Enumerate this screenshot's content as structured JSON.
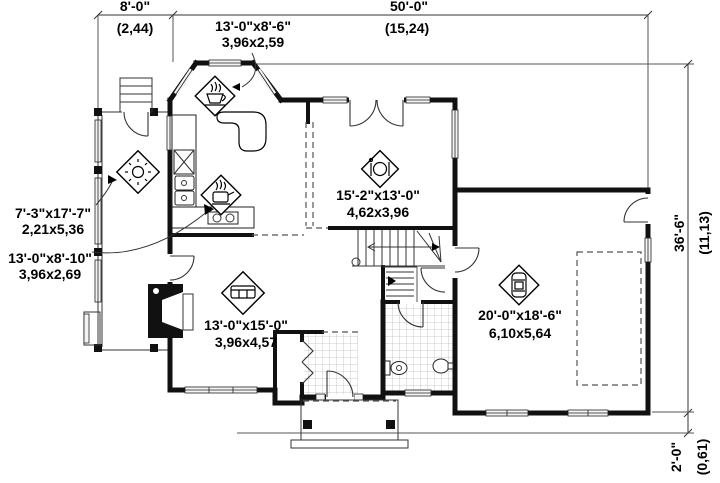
{
  "drawing_type": "first-floor-plan",
  "dimensions": {
    "top_left": {
      "imperial": "8'-0\"",
      "metric": "(2,44)"
    },
    "top": {
      "imperial": "50'-0\"",
      "metric": "(15,24)"
    },
    "right": {
      "imperial": "36'-6\"",
      "metric": "(11,13)"
    },
    "bottom_right": {
      "imperial": "2'-0\"",
      "metric": "(0,61)"
    }
  },
  "rooms": {
    "dinette": {
      "imperial": "13'-0\"x8'-6\"",
      "metric": "3,96x2,59",
      "icon": "coffee-cup"
    },
    "covered_porch": {
      "imperial": "7'-3\"x17'-7\"",
      "metric": "2,21x5,36",
      "icon": "sun"
    },
    "kitchen": {
      "imperial": "13'-0\"x8'-10\"",
      "metric": "3,96x2,69",
      "icon": "kettle"
    },
    "dining_room": {
      "imperial": "15'-2\"x13'-0\"",
      "metric": "4,62x3,96",
      "icon": "plate-and-cutlery"
    },
    "living_room": {
      "imperial": "13'-0\"x15'-0\"",
      "metric": "3,96x4,57",
      "icon": "sofa"
    },
    "garage": {
      "imperial": "20'-0\"x18'-6\"",
      "metric": "6,10x5,64",
      "icon": "car"
    }
  }
}
